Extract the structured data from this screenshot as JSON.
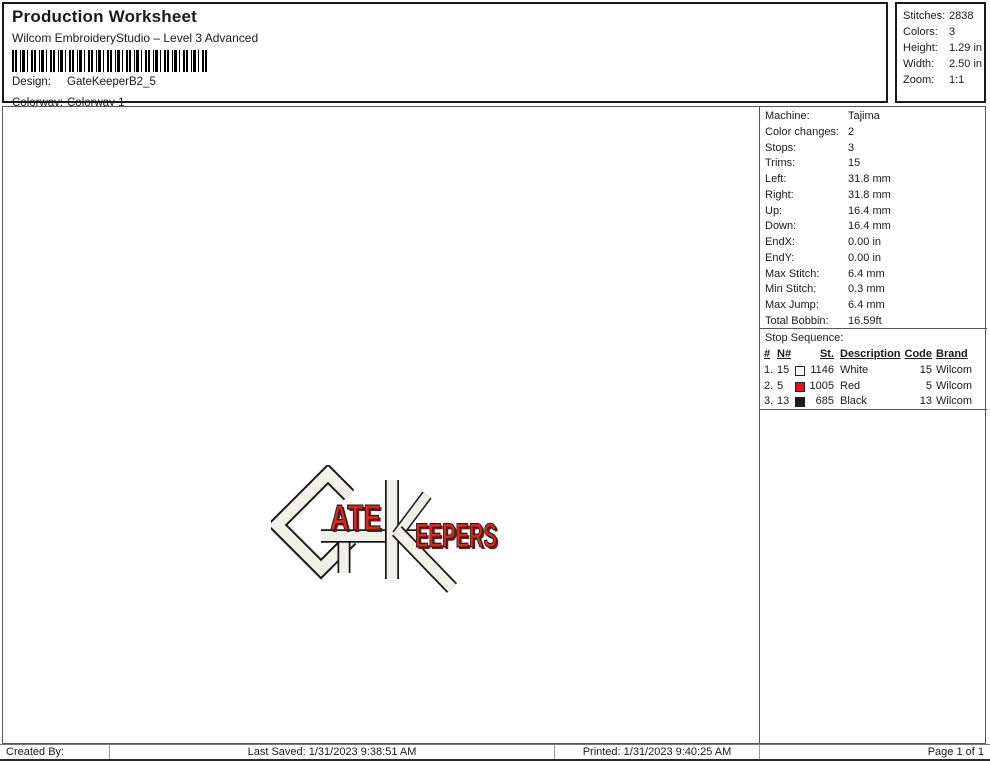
{
  "header": {
    "title": "Production Worksheet",
    "subtitle": "Wilcom EmbroideryStudio – Level 3 Advanced",
    "design_label": "Design:",
    "design_value": "GateKeeperB2_5",
    "colorway_label": "Colorway:",
    "colorway_value": "Colorway 1"
  },
  "summary": {
    "rows": [
      {
        "label": "Stitches:",
        "value": "2838"
      },
      {
        "label": "Colors:",
        "value": "3"
      },
      {
        "label": "Height:",
        "value": "1.29 in"
      },
      {
        "label": "Width:",
        "value": "2.50 in"
      },
      {
        "label": "Zoom:",
        "value": "1:1"
      }
    ]
  },
  "machine_info": {
    "rows": [
      {
        "label": "Machine:",
        "value": "Tajima"
      },
      {
        "label": "Color changes:",
        "value": "2"
      },
      {
        "label": "Stops:",
        "value": "3"
      },
      {
        "label": "Trims:",
        "value": "15"
      },
      {
        "label": "Left:",
        "value": "31.8 mm"
      },
      {
        "label": "Right:",
        "value": "31.8 mm"
      },
      {
        "label": "Up:",
        "value": "16.4 mm"
      },
      {
        "label": "Down:",
        "value": "16.4 mm"
      },
      {
        "label": "EndX:",
        "value": "0.00 in"
      },
      {
        "label": "EndY:",
        "value": "0.00 in"
      },
      {
        "label": "Max Stitch:",
        "value": "6.4 mm"
      },
      {
        "label": "Min Stitch:",
        "value": "0.3 mm"
      },
      {
        "label": "Max Jump:",
        "value": "6.4 mm"
      },
      {
        "label": "Total Bobbin:",
        "value": "16.59ft"
      }
    ]
  },
  "stop_sequence": {
    "title": "Stop Sequence:",
    "columns": {
      "num": "#",
      "n": "N#",
      "st": "St.",
      "description": "Description",
      "code": "Code",
      "brand": "Brand"
    },
    "rows": [
      {
        "num": "1.",
        "n": "15",
        "swatch": "#ffffff",
        "st": "1146",
        "description": "White",
        "code": "15",
        "brand": "Wilcom"
      },
      {
        "num": "2.",
        "n": "5",
        "swatch": "#e31414",
        "st": "1005",
        "description": "Red",
        "code": "5",
        "brand": "Wilcom"
      },
      {
        "num": "3.",
        "n": "13",
        "swatch": "#1c1c1c",
        "st": "685",
        "description": "Black",
        "code": "13",
        "brand": "Wilcom"
      }
    ]
  },
  "design_preview": {
    "word_ate": "ATE",
    "word_eepers": "EEPERS",
    "thread_white": "#f1f0e8",
    "thread_red": "#cb2d25",
    "thread_red_dark": "#7d1410",
    "outline_color": "#1a1a1a"
  },
  "footer": {
    "created_by": "Created By:",
    "last_saved": "Last Saved: 1/31/2023 9:38:51 AM",
    "printed": "Printed: 1/31/2023 9:40:25 AM",
    "page": "Page 1 of 1"
  }
}
